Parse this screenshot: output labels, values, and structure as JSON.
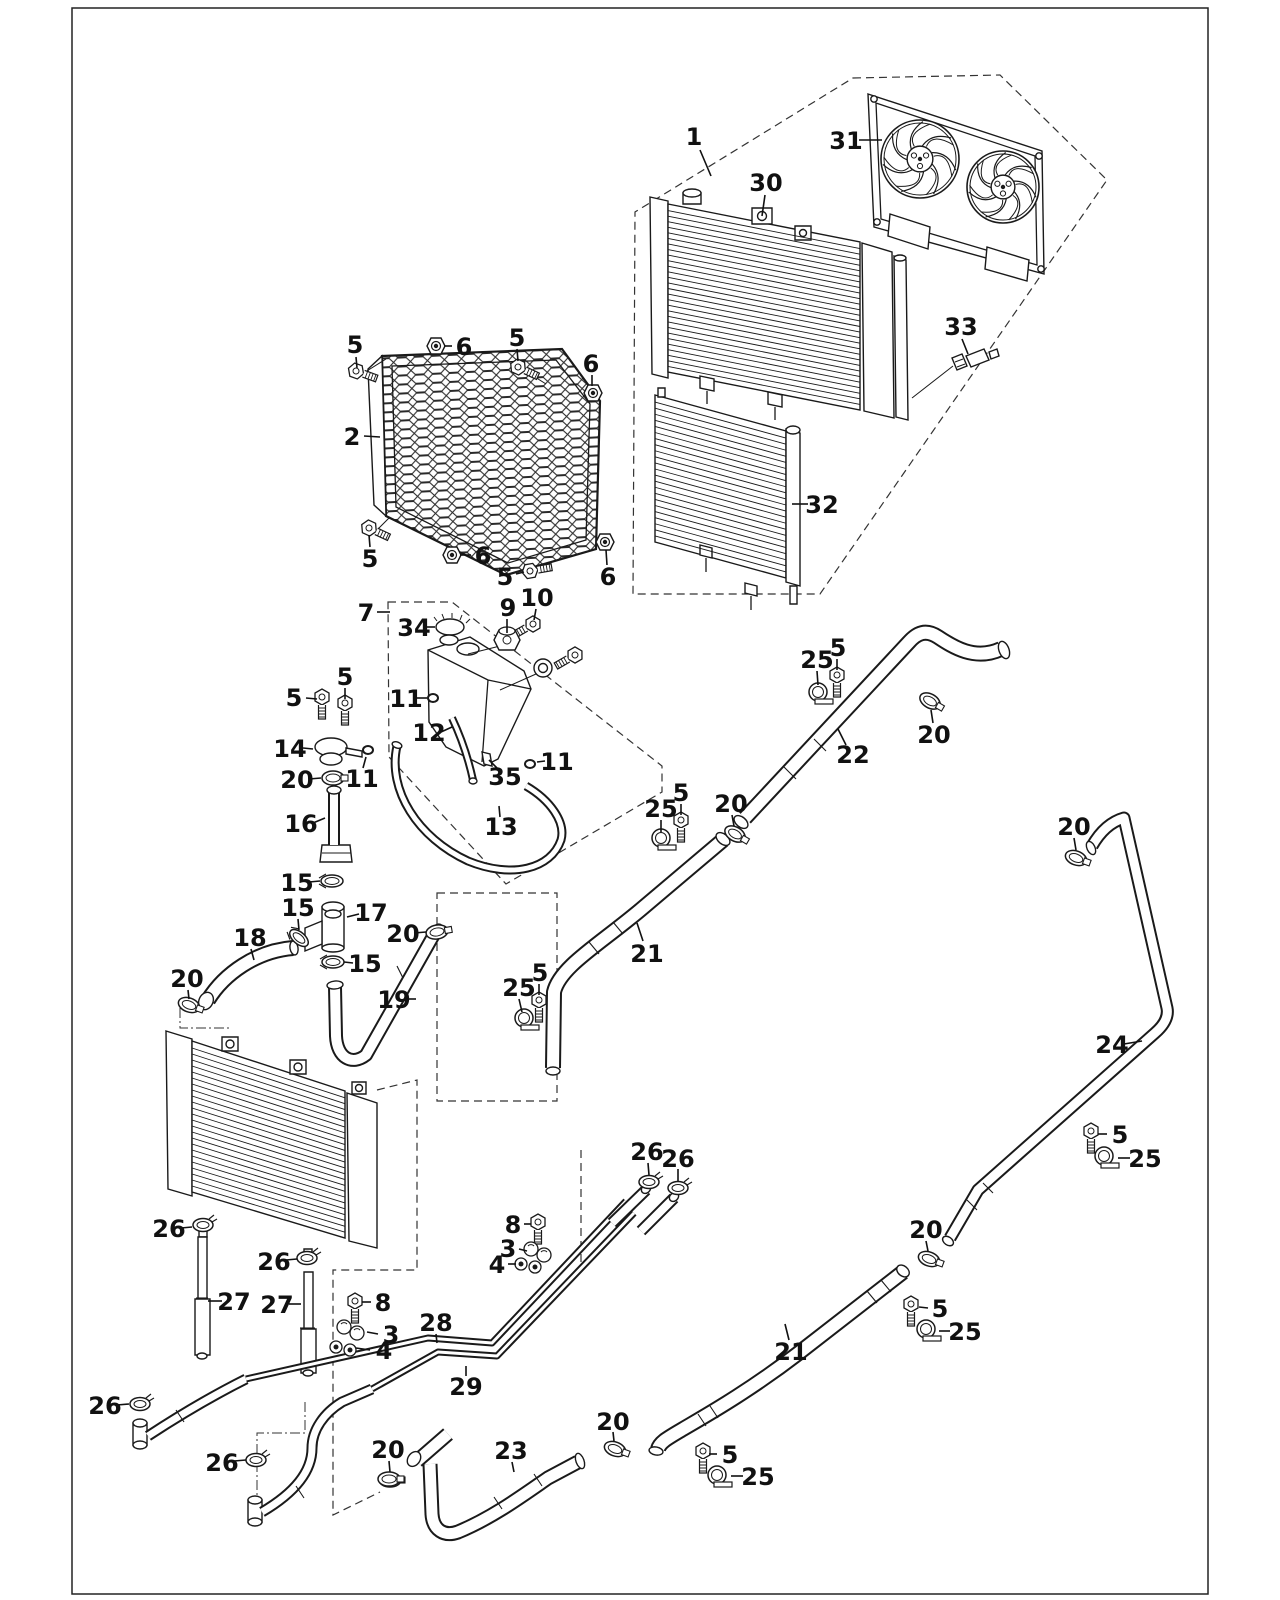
{
  "page": {
    "background": "#ffffff",
    "border_color": "#222222"
  },
  "diagram": {
    "type": "exploded-parts-diagram",
    "subject": "Radiator, cooling fans, reservoir tank and coolant hoses",
    "line_color": "#1a1a1a",
    "part_numbers_visible": [
      "1",
      "2",
      "3",
      "4",
      "5",
      "6",
      "7",
      "8",
      "9",
      "10",
      "11",
      "12",
      "13",
      "14",
      "15",
      "16",
      "17",
      "18",
      "19",
      "20",
      "21",
      "22",
      "23",
      "24",
      "25",
      "26",
      "27",
      "28",
      "29",
      "30",
      "31",
      "32",
      "33",
      "34",
      "35"
    ],
    "callouts": [
      {
        "n": "1",
        "tx": 694,
        "ty": 137,
        "leader": [
          700,
          150,
          711,
          176
        ]
      },
      {
        "n": "30",
        "tx": 766,
        "ty": 183,
        "leader": [
          765,
          195,
          762,
          216
        ]
      },
      {
        "n": "31",
        "tx": 846,
        "ty": 141,
        "leader": [
          859,
          140,
          882,
          140
        ]
      },
      {
        "n": "33",
        "tx": 961,
        "ty": 327,
        "leader": [
          962,
          339,
          968,
          354
        ]
      },
      {
        "n": "32",
        "tx": 822,
        "ty": 505,
        "leader": [
          808,
          504,
          792,
          504
        ]
      },
      {
        "n": "2",
        "tx": 352,
        "ty": 437,
        "leader": [
          364,
          436,
          380,
          437
        ]
      },
      {
        "n": "5",
        "tx": 355,
        "ty": 345,
        "leader": [
          356,
          357,
          357,
          368
        ]
      },
      {
        "n": "6",
        "tx": 464,
        "ty": 347,
        "leader": [
          452,
          346,
          444,
          346
        ]
      },
      {
        "n": "5",
        "tx": 517,
        "ty": 338,
        "leader": [
          517,
          349,
          518,
          361
        ]
      },
      {
        "n": "6",
        "tx": 591,
        "ty": 364,
        "leader": [
          592,
          375,
          592,
          386
        ]
      },
      {
        "n": "5",
        "tx": 370,
        "ty": 559,
        "leader": [
          370,
          547,
          369,
          535
        ]
      },
      {
        "n": "6",
        "tx": 483,
        "ty": 556,
        "leader": [
          471,
          555,
          460,
          555
        ]
      },
      {
        "n": "5",
        "tx": 505,
        "ty": 577,
        "leader": [
          516,
          574,
          524,
          572
        ]
      },
      {
        "n": "6",
        "tx": 608,
        "ty": 577,
        "leader": [
          607,
          565,
          606,
          550
        ]
      },
      {
        "n": "7",
        "tx": 366,
        "ty": 613,
        "leader": [
          377,
          612,
          390,
          612
        ]
      },
      {
        "n": "34",
        "tx": 414,
        "ty": 628,
        "leader": [
          425,
          627,
          435,
          627
        ]
      },
      {
        "n": "9",
        "tx": 508,
        "ty": 608,
        "leader": [
          507,
          619,
          507,
          633
        ]
      },
      {
        "n": "10",
        "tx": 537,
        "ty": 598,
        "leader": [
          536,
          609,
          534,
          620
        ]
      },
      {
        "n": "11",
        "tx": 406,
        "ty": 699,
        "leader": [
          417,
          698,
          427,
          698
        ]
      },
      {
        "n": "12",
        "tx": 429,
        "ty": 733,
        "leader": [
          441,
          732,
          452,
          727
        ]
      },
      {
        "n": "35",
        "tx": 505,
        "ty": 777,
        "leader": [
          497,
          768,
          489,
          760
        ]
      },
      {
        "n": "11",
        "tx": 557,
        "ty": 762,
        "leader": [
          545,
          761,
          537,
          762
        ]
      },
      {
        "n": "13",
        "tx": 501,
        "ty": 827,
        "leader": [
          500,
          817,
          499,
          806
        ]
      },
      {
        "n": "11",
        "tx": 362,
        "ty": 779,
        "leader": [
          363,
          768,
          366,
          757
        ]
      },
      {
        "n": "5",
        "tx": 294,
        "ty": 698,
        "leader": [
          306,
          698,
          317,
          699
        ]
      },
      {
        "n": "5",
        "tx": 345,
        "ty": 677,
        "leader": [
          345,
          688,
          345,
          699
        ]
      },
      {
        "n": "14",
        "tx": 290,
        "ty": 749,
        "leader": [
          303,
          748,
          313,
          749
        ]
      },
      {
        "n": "20",
        "tx": 297,
        "ty": 780,
        "leader": [
          309,
          779,
          321,
          778
        ]
      },
      {
        "n": "16",
        "tx": 301,
        "ty": 824,
        "leader": [
          313,
          823,
          325,
          818
        ]
      },
      {
        "n": "15",
        "tx": 297,
        "ty": 883,
        "leader": [
          309,
          882,
          320,
          881
        ]
      },
      {
        "n": "15",
        "tx": 298,
        "ty": 908,
        "leader": [
          298,
          919,
          299,
          930
        ]
      },
      {
        "n": "17",
        "tx": 371,
        "ty": 913,
        "leader": [
          359,
          914,
          347,
          917
        ]
      },
      {
        "n": "15",
        "tx": 365,
        "ty": 964,
        "leader": [
          353,
          963,
          344,
          962
        ]
      },
      {
        "n": "18",
        "tx": 250,
        "ty": 938,
        "leader": [
          251,
          949,
          254,
          960
        ]
      },
      {
        "n": "20",
        "tx": 187,
        "ty": 979,
        "leader": [
          188,
          990,
          189,
          999
        ]
      },
      {
        "n": "20",
        "tx": 403,
        "ty": 934,
        "leader": [
          414,
          933,
          426,
          932
        ]
      },
      {
        "n": "19",
        "tx": 394,
        "ty": 1000,
        "leader": [
          405,
          999,
          416,
          999
        ]
      },
      {
        "n": "25",
        "tx": 817,
        "ty": 660,
        "leader": [
          817,
          671,
          818,
          685
        ]
      },
      {
        "n": "5",
        "tx": 838,
        "ty": 648,
        "leader": [
          837,
          659,
          837,
          670
        ]
      },
      {
        "n": "22",
        "tx": 853,
        "ty": 755,
        "leader": [
          846,
          745,
          838,
          729
        ]
      },
      {
        "n": "20",
        "tx": 934,
        "ty": 735,
        "leader": [
          933,
          723,
          931,
          710
        ]
      },
      {
        "n": "25",
        "tx": 661,
        "ty": 809,
        "leader": [
          661,
          820,
          661,
          832
        ]
      },
      {
        "n": "5",
        "tx": 681,
        "ty": 793,
        "leader": [
          681,
          804,
          681,
          815
        ]
      },
      {
        "n": "20",
        "tx": 731,
        "ty": 804,
        "leader": [
          732,
          815,
          734,
          826
        ]
      },
      {
        "n": "21",
        "tx": 647,
        "ty": 954,
        "leader": [
          643,
          941,
          637,
          923
        ]
      },
      {
        "n": "5",
        "tx": 540,
        "ty": 973,
        "leader": [
          539,
          984,
          539,
          995
        ]
      },
      {
        "n": "25",
        "tx": 519,
        "ty": 988,
        "leader": [
          519,
          999,
          522,
          1012
        ]
      },
      {
        "n": "20",
        "tx": 1074,
        "ty": 827,
        "leader": [
          1074,
          838,
          1076,
          850
        ]
      },
      {
        "n": "24",
        "tx": 1112,
        "ty": 1045,
        "leader": [
          1124,
          1044,
          1142,
          1041
        ]
      },
      {
        "n": "5",
        "tx": 1120,
        "ty": 1135,
        "leader": [
          1107,
          1134,
          1098,
          1134
        ]
      },
      {
        "n": "25",
        "tx": 1145,
        "ty": 1159,
        "leader": [
          1130,
          1158,
          1118,
          1158
        ]
      },
      {
        "n": "20",
        "tx": 926,
        "ty": 1230,
        "leader": [
          926,
          1241,
          928,
          1251
        ]
      },
      {
        "n": "5",
        "tx": 940,
        "ty": 1309,
        "leader": [
          928,
          1308,
          919,
          1307
        ]
      },
      {
        "n": "25",
        "tx": 965,
        "ty": 1332,
        "leader": [
          950,
          1331,
          939,
          1331
        ]
      },
      {
        "n": "21",
        "tx": 791,
        "ty": 1352,
        "leader": [
          789,
          1340,
          785,
          1324
        ]
      },
      {
        "n": "5",
        "tx": 730,
        "ty": 1455,
        "leader": [
          717,
          1454,
          709,
          1454
        ]
      },
      {
        "n": "25",
        "tx": 758,
        "ty": 1477,
        "leader": [
          743,
          1476,
          731,
          1476
        ]
      },
      {
        "n": "26",
        "tx": 169,
        "ty": 1229,
        "leader": [
          181,
          1228,
          192,
          1227
        ]
      },
      {
        "n": "26",
        "tx": 274,
        "ty": 1262,
        "leader": [
          286,
          1260,
          297,
          1259
        ]
      },
      {
        "n": "27",
        "tx": 234,
        "ty": 1302,
        "leader": [
          222,
          1301,
          208,
          1301
        ]
      },
      {
        "n": "27",
        "tx": 277,
        "ty": 1305,
        "leader": [
          289,
          1304,
          301,
          1304
        ]
      },
      {
        "n": "8",
        "tx": 513,
        "ty": 1225,
        "leader": [
          524,
          1224,
          531,
          1224
        ]
      },
      {
        "n": "3",
        "tx": 508,
        "ty": 1249,
        "leader": [
          519,
          1249,
          527,
          1251
        ]
      },
      {
        "n": "4",
        "tx": 497,
        "ty": 1265,
        "leader": [
          508,
          1264,
          516,
          1264
        ]
      },
      {
        "n": "8",
        "tx": 383,
        "ty": 1303,
        "leader": [
          371,
          1302,
          362,
          1302
        ]
      },
      {
        "n": "3",
        "tx": 391,
        "ty": 1335,
        "leader": [
          378,
          1334,
          367,
          1332
        ]
      },
      {
        "n": "4",
        "tx": 384,
        "ty": 1351,
        "leader": [
          370,
          1350,
          356,
          1348
        ]
      },
      {
        "n": "28",
        "tx": 436,
        "ty": 1323,
        "leader": [
          436,
          1334,
          437,
          1343
        ]
      },
      {
        "n": "29",
        "tx": 466,
        "ty": 1387,
        "leader": [
          466,
          1376,
          466,
          1366
        ]
      },
      {
        "n": "26",
        "tx": 105,
        "ty": 1406,
        "leader": [
          117,
          1405,
          129,
          1404
        ]
      },
      {
        "n": "26",
        "tx": 222,
        "ty": 1463,
        "leader": [
          234,
          1461,
          246,
          1460
        ]
      },
      {
        "n": "20",
        "tx": 388,
        "ty": 1450,
        "leader": [
          389,
          1461,
          390,
          1472
        ]
      },
      {
        "n": "23",
        "tx": 511,
        "ty": 1451,
        "leader": [
          512,
          1462,
          514,
          1472
        ]
      },
      {
        "n": "20",
        "tx": 613,
        "ty": 1422,
        "leader": [
          613,
          1432,
          614,
          1441
        ]
      },
      {
        "n": "26",
        "tx": 647,
        "ty": 1152,
        "leader": [
          648,
          1163,
          649,
          1175
        ]
      },
      {
        "n": "26",
        "tx": 678,
        "ty": 1159,
        "leader": [
          678,
          1169,
          678,
          1181
        ]
      }
    ]
  }
}
